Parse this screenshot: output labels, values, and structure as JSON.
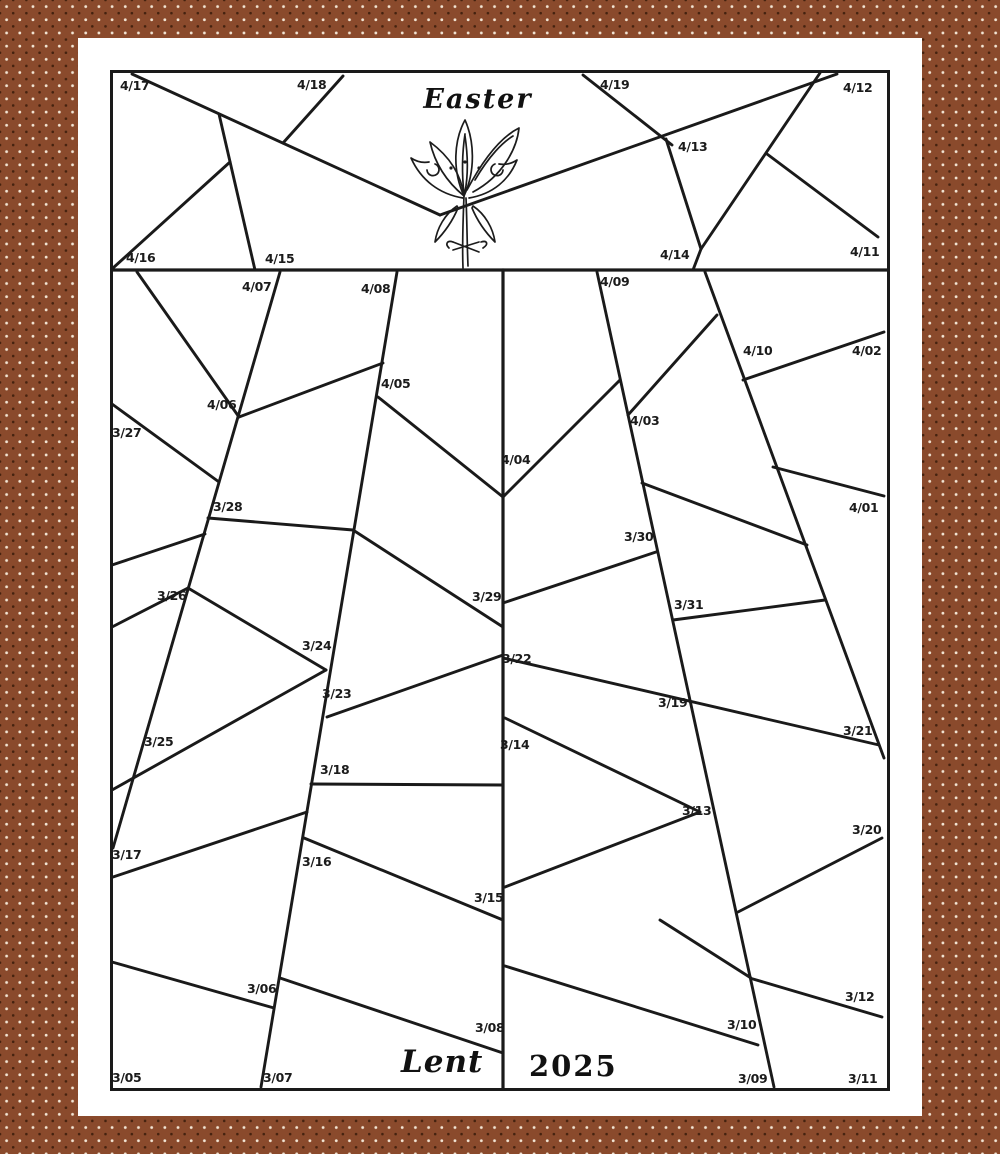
{
  "page": {
    "kind": "printable coloring countdown calendar",
    "season": "Lent",
    "year": "2025",
    "first_date": "3/05",
    "last_date": "4/19",
    "total_days": 46
  },
  "titles": {
    "easter": "Easter",
    "lent": "Lent",
    "year": "2025"
  },
  "colors": {
    "background_brown": "#8a4a2c",
    "dot_light": "#f2e5d4",
    "dot_dark": "#44220f",
    "paper": "#ffffff",
    "ink": "#1a1a1a"
  },
  "icons": {
    "lily": "easter-lily-illustration"
  },
  "date_cells": [
    {
      "d": "4/17",
      "x": 120,
      "y": 80
    },
    {
      "d": "4/18",
      "x": 297,
      "y": 79
    },
    {
      "d": "4/19",
      "x": 600,
      "y": 79
    },
    {
      "d": "4/12",
      "x": 843,
      "y": 82
    },
    {
      "d": "4/13",
      "x": 678,
      "y": 141
    },
    {
      "d": "4/16",
      "x": 126,
      "y": 252
    },
    {
      "d": "4/15",
      "x": 265,
      "y": 253
    },
    {
      "d": "4/14",
      "x": 660,
      "y": 249
    },
    {
      "d": "4/11",
      "x": 850,
      "y": 246
    },
    {
      "d": "4/07",
      "x": 242,
      "y": 281
    },
    {
      "d": "4/08",
      "x": 361,
      "y": 283
    },
    {
      "d": "4/09",
      "x": 600,
      "y": 276
    },
    {
      "d": "4/10",
      "x": 743,
      "y": 345
    },
    {
      "d": "4/02",
      "x": 852,
      "y": 345
    },
    {
      "d": "4/05",
      "x": 381,
      "y": 378
    },
    {
      "d": "4/06",
      "x": 207,
      "y": 399
    },
    {
      "d": "4/03",
      "x": 630,
      "y": 415
    },
    {
      "d": "3/27",
      "x": 112,
      "y": 427
    },
    {
      "d": "4/04",
      "x": 501,
      "y": 454
    },
    {
      "d": "3/28",
      "x": 213,
      "y": 501
    },
    {
      "d": "4/01",
      "x": 849,
      "y": 502
    },
    {
      "d": "3/30",
      "x": 624,
      "y": 531
    },
    {
      "d": "3/26",
      "x": 157,
      "y": 590
    },
    {
      "d": "3/29",
      "x": 472,
      "y": 591
    },
    {
      "d": "3/31",
      "x": 674,
      "y": 599
    },
    {
      "d": "3/24",
      "x": 302,
      "y": 640
    },
    {
      "d": "3/22",
      "x": 502,
      "y": 653
    },
    {
      "d": "3/23",
      "x": 322,
      "y": 688
    },
    {
      "d": "3/19",
      "x": 658,
      "y": 697
    },
    {
      "d": "3/21",
      "x": 843,
      "y": 725
    },
    {
      "d": "3/25",
      "x": 144,
      "y": 736
    },
    {
      "d": "3/14",
      "x": 500,
      "y": 739
    },
    {
      "d": "3/18",
      "x": 320,
      "y": 764
    },
    {
      "d": "3/13",
      "x": 682,
      "y": 805
    },
    {
      "d": "3/20",
      "x": 852,
      "y": 824
    },
    {
      "d": "3/17",
      "x": 112,
      "y": 849
    },
    {
      "d": "3/16",
      "x": 302,
      "y": 856
    },
    {
      "d": "3/15",
      "x": 474,
      "y": 892
    },
    {
      "d": "3/06",
      "x": 247,
      "y": 983
    },
    {
      "d": "3/12",
      "x": 845,
      "y": 991
    },
    {
      "d": "3/10",
      "x": 727,
      "y": 1019
    },
    {
      "d": "3/08",
      "x": 475,
      "y": 1022
    },
    {
      "d": "3/05",
      "x": 112,
      "y": 1072
    },
    {
      "d": "3/07",
      "x": 263,
      "y": 1072
    },
    {
      "d": "3/09",
      "x": 738,
      "y": 1073
    },
    {
      "d": "3/11",
      "x": 848,
      "y": 1073
    }
  ],
  "shard_lines": [
    {
      "x1": 112,
      "y1": 270,
      "x2": 888,
      "y2": 270,
      "w": 3.2
    },
    {
      "x1": 503,
      "y1": 270,
      "x2": 503,
      "y2": 1089,
      "w": 3.2
    },
    {
      "x1": 132,
      "y1": 74,
      "x2": 440,
      "y2": 215
    },
    {
      "x1": 343,
      "y1": 76,
      "x2": 283,
      "y2": 143
    },
    {
      "x1": 219,
      "y1": 114,
      "x2": 255,
      "y2": 270
    },
    {
      "x1": 230,
      "y1": 162,
      "x2": 113,
      "y2": 268
    },
    {
      "x1": 440,
      "y1": 215,
      "x2": 837,
      "y2": 74
    },
    {
      "x1": 583,
      "y1": 75,
      "x2": 672,
      "y2": 145
    },
    {
      "x1": 666,
      "y1": 139,
      "x2": 701,
      "y2": 249
    },
    {
      "x1": 701,
      "y1": 249,
      "x2": 693,
      "y2": 270
    },
    {
      "x1": 701,
      "y1": 249,
      "x2": 820,
      "y2": 73
    },
    {
      "x1": 767,
      "y1": 154,
      "x2": 878,
      "y2": 237
    },
    {
      "x1": 280,
      "y1": 272,
      "x2": 113,
      "y2": 848
    },
    {
      "x1": 397,
      "y1": 272,
      "x2": 261,
      "y2": 1087
    },
    {
      "x1": 597,
      "y1": 272,
      "x2": 774,
      "y2": 1087
    },
    {
      "x1": 705,
      "y1": 272,
      "x2": 884,
      "y2": 758
    },
    {
      "x1": 137,
      "y1": 272,
      "x2": 239,
      "y2": 417
    },
    {
      "x1": 112,
      "y1": 404,
      "x2": 219,
      "y2": 482
    },
    {
      "x1": 112,
      "y1": 565,
      "x2": 205,
      "y2": 534
    },
    {
      "x1": 112,
      "y1": 627,
      "x2": 188,
      "y2": 588
    },
    {
      "x1": 112,
      "y1": 790,
      "x2": 326,
      "y2": 670
    },
    {
      "x1": 113,
      "y1": 877,
      "x2": 307,
      "y2": 812
    },
    {
      "x1": 112,
      "y1": 962,
      "x2": 274,
      "y2": 1008
    },
    {
      "x1": 383,
      "y1": 363,
      "x2": 239,
      "y2": 417
    },
    {
      "x1": 208,
      "y1": 518,
      "x2": 353,
      "y2": 530
    },
    {
      "x1": 188,
      "y1": 588,
      "x2": 326,
      "y2": 670
    },
    {
      "x1": 378,
      "y1": 397,
      "x2": 503,
      "y2": 497
    },
    {
      "x1": 353,
      "y1": 530,
      "x2": 503,
      "y2": 627
    },
    {
      "x1": 327,
      "y1": 717,
      "x2": 503,
      "y2": 655
    },
    {
      "x1": 311,
      "y1": 784,
      "x2": 503,
      "y2": 785
    },
    {
      "x1": 304,
      "y1": 838,
      "x2": 503,
      "y2": 920
    },
    {
      "x1": 280,
      "y1": 978,
      "x2": 503,
      "y2": 1053
    },
    {
      "x1": 503,
      "y1": 497,
      "x2": 620,
      "y2": 380
    },
    {
      "x1": 503,
      "y1": 603,
      "x2": 656,
      "y2": 552
    },
    {
      "x1": 503,
      "y1": 658,
      "x2": 879,
      "y2": 745
    },
    {
      "x1": 505,
      "y1": 718,
      "x2": 700,
      "y2": 812
    },
    {
      "x1": 505,
      "y1": 887,
      "x2": 700,
      "y2": 812
    },
    {
      "x1": 505,
      "y1": 966,
      "x2": 758,
      "y2": 1045
    },
    {
      "x1": 660,
      "y1": 920,
      "x2": 751,
      "y2": 978
    },
    {
      "x1": 717,
      "y1": 315,
      "x2": 628,
      "y2": 415
    },
    {
      "x1": 642,
      "y1": 483,
      "x2": 807,
      "y2": 545
    },
    {
      "x1": 673,
      "y1": 620,
      "x2": 825,
      "y2": 600
    },
    {
      "x1": 743,
      "y1": 380,
      "x2": 884,
      "y2": 332
    },
    {
      "x1": 773,
      "y1": 467,
      "x2": 884,
      "y2": 496
    },
    {
      "x1": 738,
      "y1": 912,
      "x2": 882,
      "y2": 838
    },
    {
      "x1": 753,
      "y1": 979,
      "x2": 882,
      "y2": 1017
    }
  ]
}
